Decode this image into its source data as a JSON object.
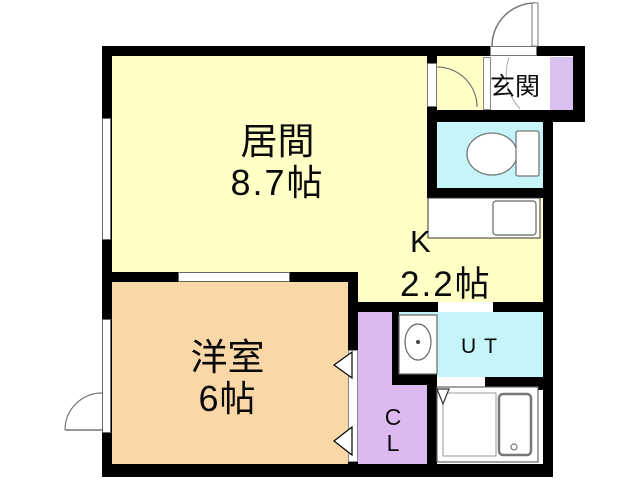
{
  "plan_type": "apartment-floor-plan",
  "labels": {
    "living_room": {
      "name": "居間",
      "size": "8.7帖"
    },
    "western_room": {
      "name": "洋室",
      "size": "6帖"
    },
    "kitchen": {
      "name": "K",
      "size": "2.2帖"
    },
    "entrance": {
      "name": "玄関"
    },
    "utility": {
      "name": "UT"
    },
    "closet": {
      "line1": "C",
      "line2": "L"
    }
  },
  "colors": {
    "living_room": "#FFFFC6",
    "kitchen": "#FFFFC6",
    "western_room": "#FAD7A6",
    "toilet": "#C5F5F8",
    "utility": "#C5F5F8",
    "closet": "#DDB9F1",
    "shoe_cabinet": "#D9C2F0",
    "wall": "#000000",
    "floor_bg": "#FFFFFF"
  },
  "fixtures": {
    "toilet": "toilet-icon",
    "kitchen_counter": "kitchen-sink-icon",
    "washing_machine": "washing-machine-icon",
    "bathtub": "bathtub-icon",
    "entrance_door": "door-swing-icon"
  }
}
